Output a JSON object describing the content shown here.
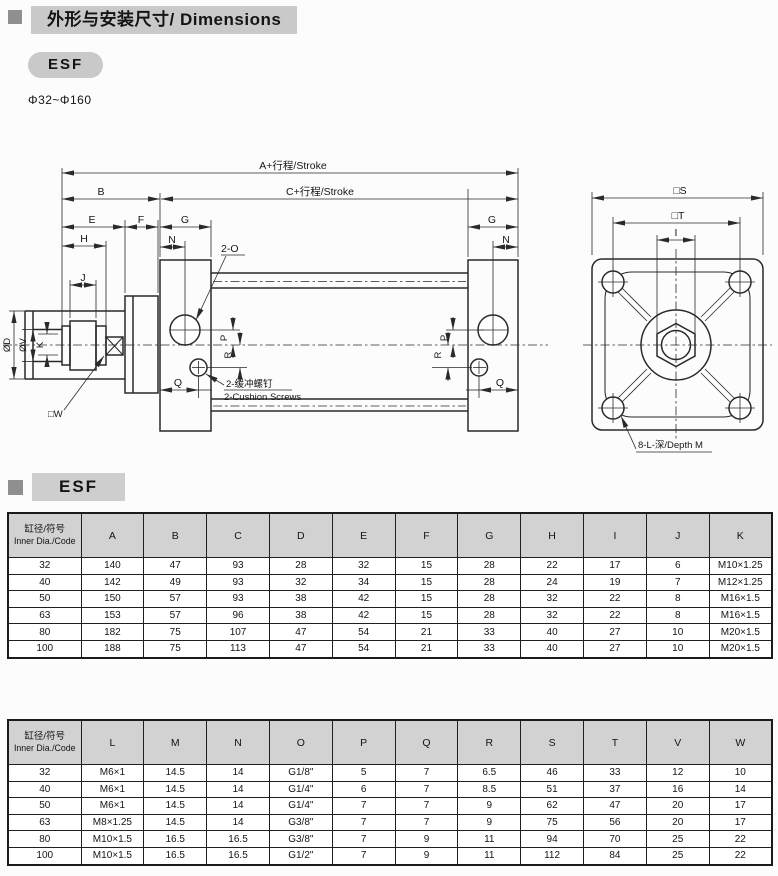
{
  "header": {
    "title": "外形与安装尺寸/ Dimensions",
    "series_badge": "ESF",
    "bore_range": "Φ32~Φ160"
  },
  "section2": {
    "title": "ESF"
  },
  "colors": {
    "title_bar_bg": "#c9c9c9",
    "table_header_bg": "#d2d2d2",
    "bullet_gray": "#8f8f8f",
    "line_color": "#2a2a2a"
  },
  "drawing": {
    "labels": {
      "stroke_a": "A+行程/Stroke",
      "stroke_c": "C+行程/Stroke",
      "b": "B",
      "e": "E",
      "f": "F",
      "g": "G",
      "h": "H",
      "n": "N",
      "j": "J",
      "p": "P",
      "r": "R",
      "q": "Q",
      "k": "K",
      "phi_d": "ØD",
      "phi_v": "ØV",
      "w": "□W",
      "ports": "2-O",
      "cushion_zh": "2-缓冲螺钉",
      "cushion_en": "2-Cushion Screws",
      "s": "□S",
      "t": "□T",
      "i": "I",
      "depth": "8-L-深/Depth M"
    }
  },
  "table1": {
    "header_col1_zh": "缸径/符号",
    "header_col1_en": "Inner Dia./Code",
    "columns": [
      "A",
      "B",
      "C",
      "D",
      "E",
      "F",
      "G",
      "H",
      "I",
      "J",
      "K"
    ],
    "rows": [
      [
        "32",
        "140",
        "47",
        "93",
        "28",
        "32",
        "15",
        "28",
        "22",
        "17",
        "6",
        "M10×1.25"
      ],
      [
        "40",
        "142",
        "49",
        "93",
        "32",
        "34",
        "15",
        "28",
        "24",
        "19",
        "7",
        "M12×1.25"
      ],
      [
        "50",
        "150",
        "57",
        "93",
        "38",
        "42",
        "15",
        "28",
        "32",
        "22",
        "8",
        "M16×1.5"
      ],
      [
        "63",
        "153",
        "57",
        "96",
        "38",
        "42",
        "15",
        "28",
        "32",
        "22",
        "8",
        "M16×1.5"
      ],
      [
        "80",
        "182",
        "75",
        "107",
        "47",
        "54",
        "21",
        "33",
        "40",
        "27",
        "10",
        "M20×1.5"
      ],
      [
        "100",
        "188",
        "75",
        "113",
        "47",
        "54",
        "21",
        "33",
        "40",
        "27",
        "10",
        "M20×1.5"
      ]
    ]
  },
  "table2": {
    "header_col1_zh": "缸径/符号",
    "header_col1_en": "Inner Dia./Code",
    "columns": [
      "L",
      "M",
      "N",
      "O",
      "P",
      "Q",
      "R",
      "S",
      "T",
      "V",
      "W"
    ],
    "rows": [
      [
        "32",
        "M6×1",
        "14.5",
        "14",
        "G1/8\"",
        "5",
        "7",
        "6.5",
        "46",
        "33",
        "12",
        "10"
      ],
      [
        "40",
        "M6×1",
        "14.5",
        "14",
        "G1/4\"",
        "6",
        "7",
        "8.5",
        "51",
        "37",
        "16",
        "14"
      ],
      [
        "50",
        "M6×1",
        "14.5",
        "14",
        "G1/4\"",
        "7",
        "7",
        "9",
        "62",
        "47",
        "20",
        "17"
      ],
      [
        "63",
        "M8×1.25",
        "14.5",
        "14",
        "G3/8\"",
        "7",
        "7",
        "9",
        "75",
        "56",
        "20",
        "17"
      ],
      [
        "80",
        "M10×1.5",
        "16.5",
        "16.5",
        "G3/8\"",
        "7",
        "9",
        "11",
        "94",
        "70",
        "25",
        "22"
      ],
      [
        "100",
        "M10×1.5",
        "16.5",
        "16.5",
        "G1/2\"",
        "7",
        "9",
        "11",
        "112",
        "84",
        "25",
        "22"
      ]
    ]
  }
}
